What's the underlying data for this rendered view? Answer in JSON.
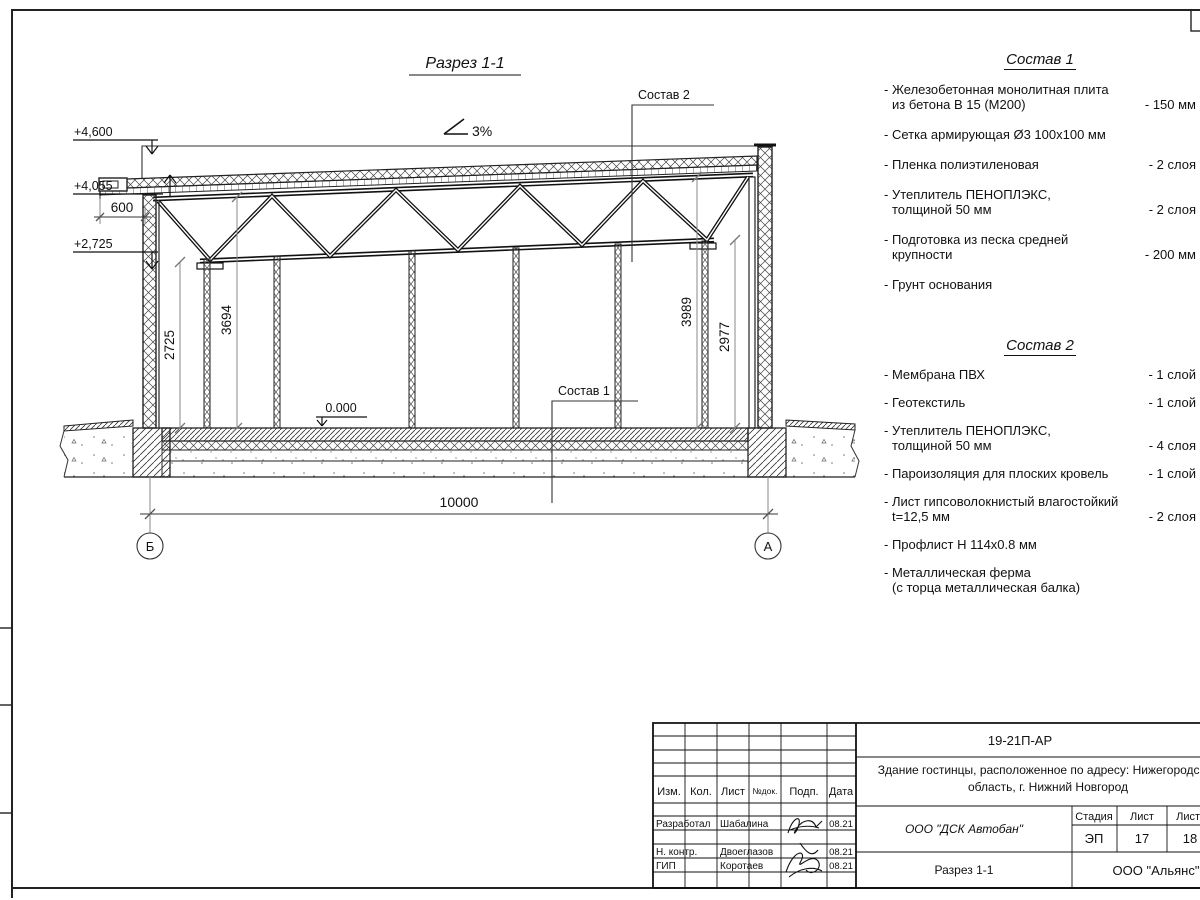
{
  "drawing": {
    "section_title": "Разрез 1-1",
    "slope": "3%",
    "level_top": "+4,600",
    "level_roof": "+4,055",
    "level_truss": "+2,725",
    "level_zero": "0.000",
    "dim_overhang": "600",
    "dim_left_inner": "2725",
    "dim_left_outer": "3694",
    "dim_right_outer": "3989",
    "dim_right_inner": "2977",
    "dim_span": "10000",
    "axis_left": "Б",
    "axis_right": "А",
    "callout1": "Состав 1",
    "callout2": "Состав 2"
  },
  "sostav1": {
    "title": "Состав 1",
    "items": [
      {
        "l1": "- Железобетонная  монолитная плита",
        "l2": "из бетона В 15 (М200)",
        "v": "- 150 мм"
      },
      {
        "l1": "- Сетка армирующая Ø3 100х100 мм",
        "l2": "",
        "v": ""
      },
      {
        "l1": "- Пленка полиэтиленовая",
        "l2": "",
        "v": "- 2 слоя"
      },
      {
        "l1": "- Утеплитель ПЕНОПЛЭКС,",
        "l2": "толщиной 50 мм",
        "v": "- 2 слоя"
      },
      {
        "l1": "- Подготовка из песка средней",
        "l2": "крупности",
        "v": "- 200 мм"
      },
      {
        "l1": "- Грунт основания",
        "l2": "",
        "v": ""
      }
    ]
  },
  "sostav2": {
    "title": "Состав 2",
    "items": [
      {
        "l1": "- Мембрана ПВХ",
        "l2": "",
        "v": "- 1 слой"
      },
      {
        "l1": "- Геотекстиль",
        "l2": "",
        "v": "- 1 слой"
      },
      {
        "l1": "- Утеплитель ПЕНОПЛЭКС,",
        "l2": "толщиной 50 мм",
        "v": "- 4 слоя"
      },
      {
        "l1": "- Пароизоляция для плоских кровель",
        "l2": "",
        "v": "- 1 слой"
      },
      {
        "l1": "- Лист гипсоволокнистый влагостойкий",
        "l2": "t=12,5 мм",
        "v": "- 2 слоя"
      },
      {
        "l1": "- Профлист Н 114х0.8 мм",
        "l2": "",
        "v": ""
      },
      {
        "l1": "- Металлическая ферма",
        "l2": "(с торца металлическая балка)",
        "v": ""
      }
    ]
  },
  "stamp": {
    "doc_number": "19-21П-АР",
    "object_line1": "Здание гостинцы, расположенное по адресу: Нижегородская",
    "object_line2": "область, г. Нижний Новгород",
    "org": "ООО \"ДСК Автобан\"",
    "sheet_name": "Разрез 1-1",
    "contractor": "ООО \"Альянс\"",
    "col_izm": "Изм.",
    "col_kol": "Кол.",
    "col_list": "Лист",
    "col_ndoc": "№док.",
    "col_podp": "Подп.",
    "col_data": "Дата",
    "stage_label": "Стадия",
    "sheet_label": "Лист",
    "sheets_label": "Листов",
    "stage": "ЭП",
    "sheet_no": "17",
    "sheets_total": "18",
    "rows": [
      {
        "role": "Разработал",
        "name": "Шабалина",
        "date": "08.21"
      },
      {
        "role": "Н. контр.",
        "name": "Двоеглазов",
        "date": "08.21"
      },
      {
        "role": "ГИП",
        "name": "Коротаев",
        "date": "08.21"
      }
    ]
  }
}
